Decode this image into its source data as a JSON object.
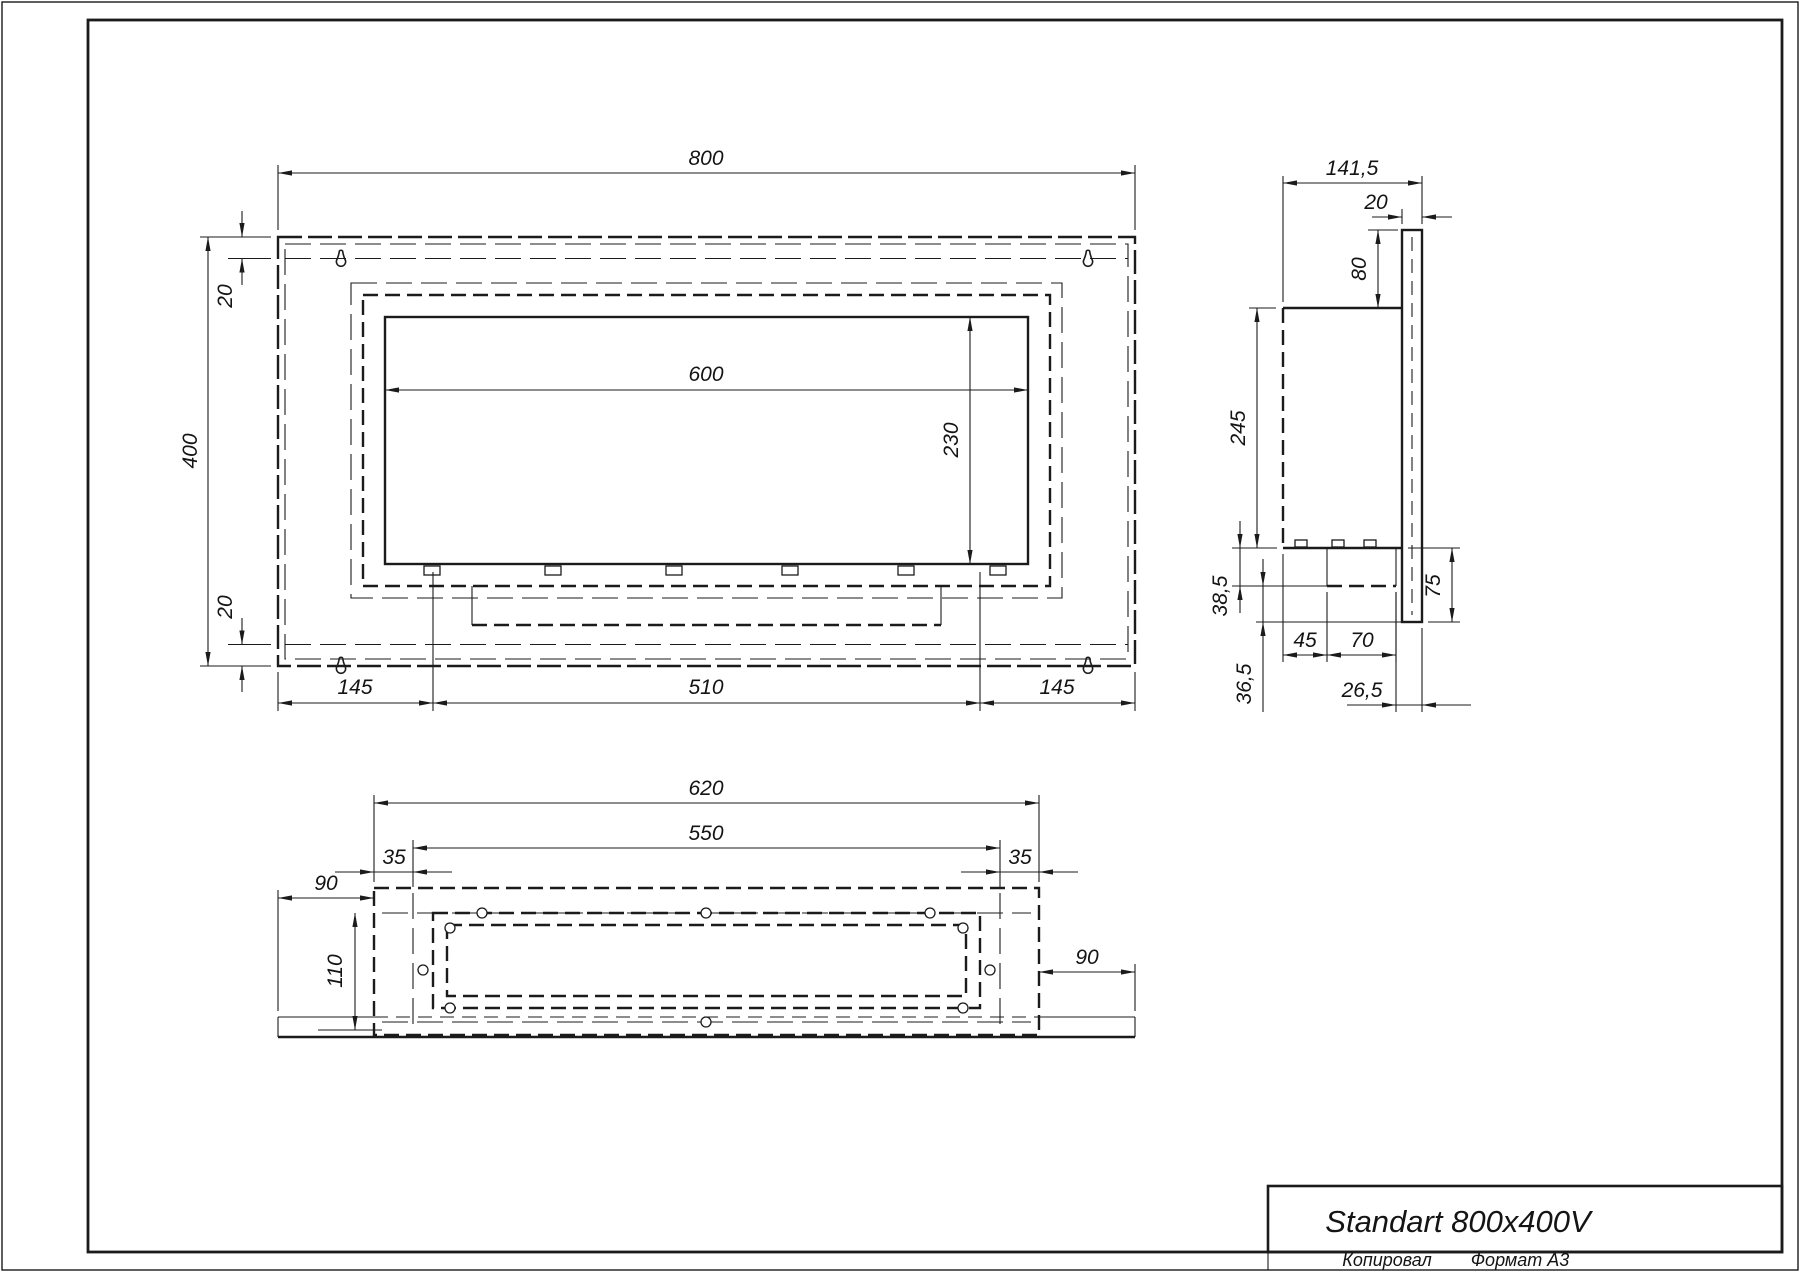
{
  "sheet": {
    "title": "Standart 800x400V",
    "footer_left": "Копировал",
    "footer_right": "Формат А3"
  },
  "colors": {
    "ink": "#1b1b1b",
    "paper": "#ffffff"
  },
  "front_view": {
    "overall_width": "800",
    "overall_height": "400",
    "top_inset": "20",
    "bottom_inset": "20",
    "opening_width": "600",
    "opening_height": "230",
    "left_margin": "145",
    "burner_width": "510",
    "right_margin": "145"
  },
  "side_view": {
    "overall_depth": "141,5",
    "panel_thickness": "20",
    "top_offset": "80",
    "body_height": "245",
    "tray_drop": "38,5",
    "tray_offset": "45",
    "tray_width": "70",
    "lower_height": "75",
    "rear_gap": "26,5",
    "lower_drop": "36,5"
  },
  "bottom_view": {
    "body_width": "620",
    "inner_width": "550",
    "left_inset": "35",
    "right_inset": "35",
    "left_flange": "90",
    "inner_depth": "110",
    "right_flange": "90"
  }
}
